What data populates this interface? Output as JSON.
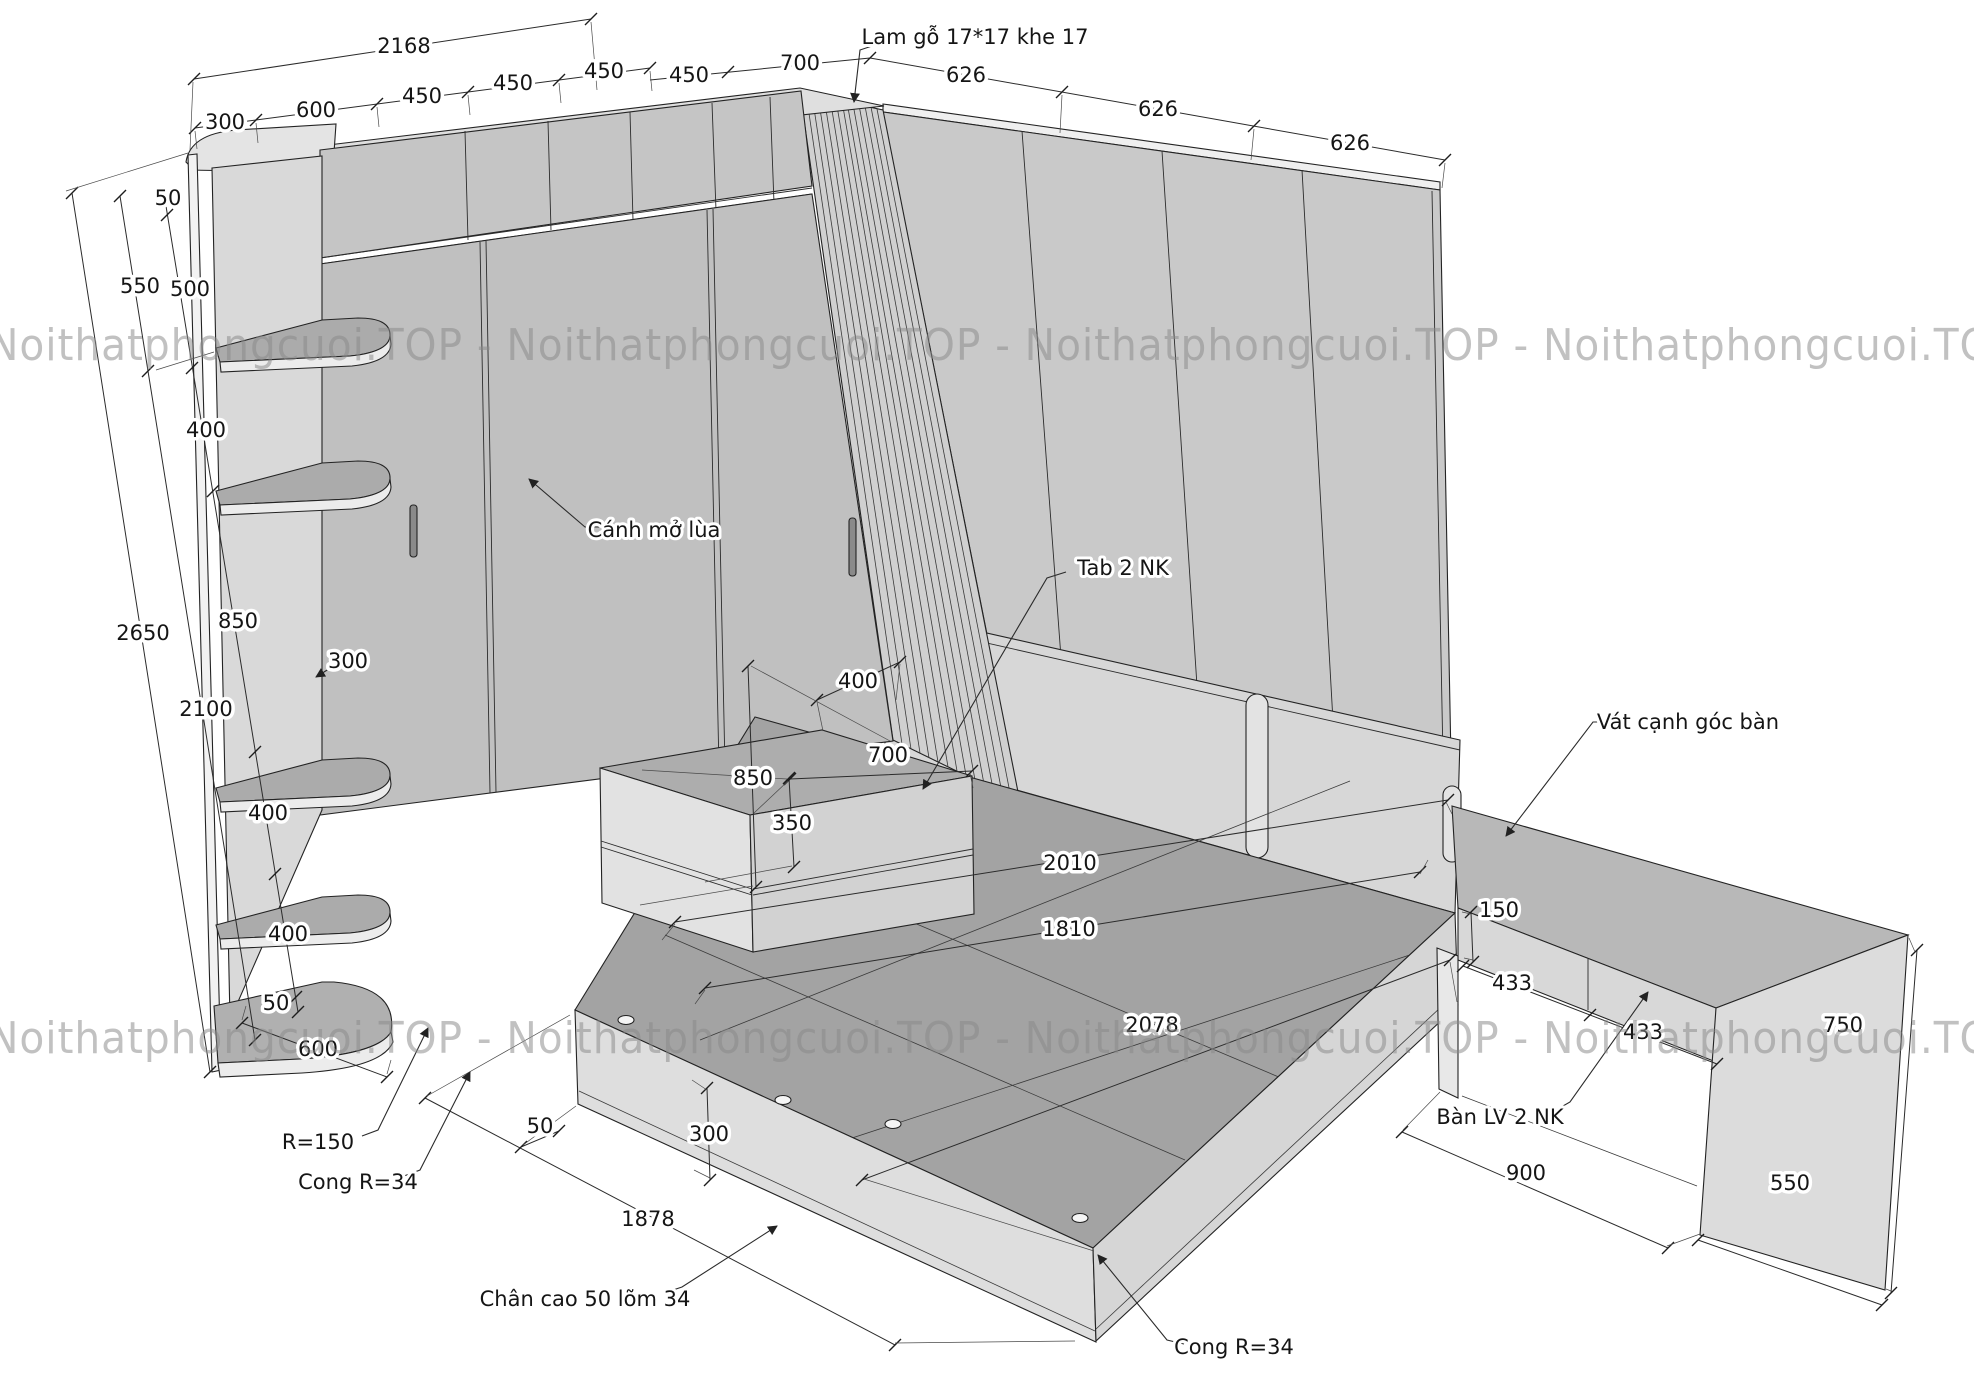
{
  "drawing": {
    "watermark_row": "Noithatphongcuoi.TOP - Noithatphongcuoi.TOP - Noithatphongcuoi.TOP - Noithatphongcuoi.TOP",
    "annotations": {
      "lam_go": "Lam gỗ 17*17 khe 17",
      "canh_mo_lua": "Cánh mở lùa",
      "tab_2nk": "Tab 2 NK",
      "vat_canh_goc_ban": "Vát cạnh góc bàn",
      "ban_lv_2nk": "Bàn LV 2 NK",
      "chan_cao": "Chân cao 50 lõm 34",
      "cong_r34_shelf": "Cong R=34",
      "cong_r34_bed": "Cong R=34",
      "r_150": "R=150"
    },
    "dims": {
      "top": {
        "overall": "2168",
        "seg300": "300",
        "seg600": "600",
        "seg450a": "450",
        "seg450b": "450",
        "seg450c": "450",
        "seg450d": "450",
        "seg700": "700",
        "seg626a": "626",
        "seg626b": "626",
        "seg626c": "626"
      },
      "left": {
        "h50_top": "50",
        "h550": "550",
        "h500": "500",
        "h400a": "400",
        "h2650": "2650",
        "h850": "850",
        "d300": "300",
        "h2100": "2100",
        "h400b": "400",
        "h400c": "400",
        "h50_bottom": "50",
        "w600": "600"
      },
      "tab": {
        "d400": "400",
        "w700": "700",
        "h850": "850",
        "h350": "350"
      },
      "bed": {
        "l2010": "2010",
        "l1810": "1810",
        "l2078": "2078",
        "h300": "300",
        "leg50": "50",
        "w1878": "1878"
      },
      "desk": {
        "drawer150": "150",
        "w433a": "433",
        "w433b": "433",
        "h750": "750",
        "w900": "900",
        "d550": "550"
      }
    }
  }
}
